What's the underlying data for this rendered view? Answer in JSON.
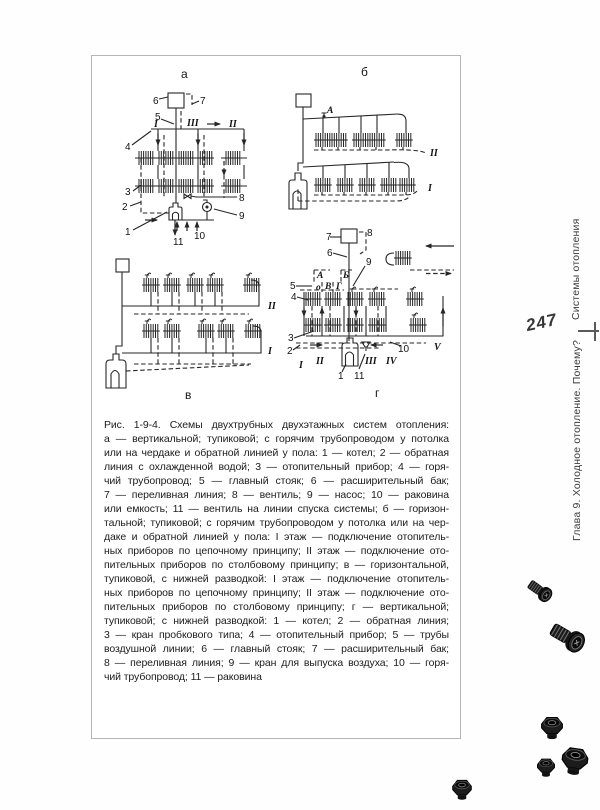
{
  "page": {
    "number": "247",
    "margin": {
      "section_title": "Системы отопления",
      "chapter_title": "Глава 9. Холодное отопление. Почему?"
    },
    "figure": {
      "panel_labels": {
        "a": "а",
        "b": "б",
        "v": "в",
        "g": "г"
      },
      "callouts": {
        "a": {
          "n1": "1",
          "n2": "2",
          "n3": "3",
          "n4": "4",
          "n5": "5",
          "n6": "6",
          "n7": "7",
          "n8": "8",
          "n9": "9",
          "n10": "10",
          "n11": "11",
          "rI": "I",
          "rII": "II",
          "rIII": "III"
        },
        "b": {
          "A": "А",
          "rI": "I",
          "rII": "II"
        },
        "v": {
          "rI": "I",
          "rII": "II"
        },
        "g": {
          "n1": "1",
          "n2": "2",
          "n3": "3",
          "n4": "4",
          "n5": "5",
          "n6": "6",
          "n7": "7",
          "n8": "8",
          "n9": "9",
          "n10": "10",
          "n11": "11",
          "A": "А",
          "B": "Б",
          "O": "о",
          "V": "В",
          "G": "Г",
          "rI": "I",
          "rII": "II",
          "rIII": "III",
          "rIV": "IV",
          "rV": "V"
        }
      },
      "caption_lines": [
        "Рис. 1-9-4. Схемы двухтрубных двухэтажных систем отопления:",
        "а — вертикальной; тупиковой; с горячим трубопроводом у потолка",
        "или на чердаке и обратной линией у пола: 1 — котел; 2 — обратная",
        "линия с охлажденной водой; 3 — отопительный прибор; 4 — горя-",
        "чий трубопровод; 5 — главный стояк; 6 — расширительный бак;",
        "7 — переливная линия; 8 — вентиль; 9 — насос; 10 — раковина",
        "или емкость; 11 — вентиль на линии спуска системы; б — горизон-",
        "тальной; тупиковой; с горячим трубопроводом у потолка или на чер-",
        "даке и обратной линией у пола: I этаж — подключение отопитель-",
        "ных приборов по цепочному принципу; II этаж — подключение ото-",
        "пительных приборов по столбовому принципу; в — горизонтальной,",
        "тупиковой, с нижней разводкой: I этаж — подключение отопитель-",
        "ных приборов по цепочному принципу; II этаж — подключение ото-",
        "пительных приборов по столбовому принципу; г — вертикальной;",
        "тупиковой; с нижней разводкой: 1 — котел; 2 — обратная линия;",
        "3 — кран пробкового типа; 4 — отопительный прибор; 5 — трубы",
        "воздушной линии; 6 — главный стояк; 7 — расширительный бак;",
        "8 — переливная линия; 9 — кран для выпуска воздуха; 10 — горя-",
        "чий трубопровод; 11 — раковина"
      ]
    },
    "decor": {
      "icons": [
        "bolt-icon",
        "bolt-icon",
        "hex-nut-icon",
        "hex-nut-icon",
        "hex-nut-icon",
        "hex-nut-icon"
      ]
    },
    "colors": {
      "ink": "#262626",
      "paper": "#ffffff",
      "margin_text": "#3d3d3d"
    }
  }
}
